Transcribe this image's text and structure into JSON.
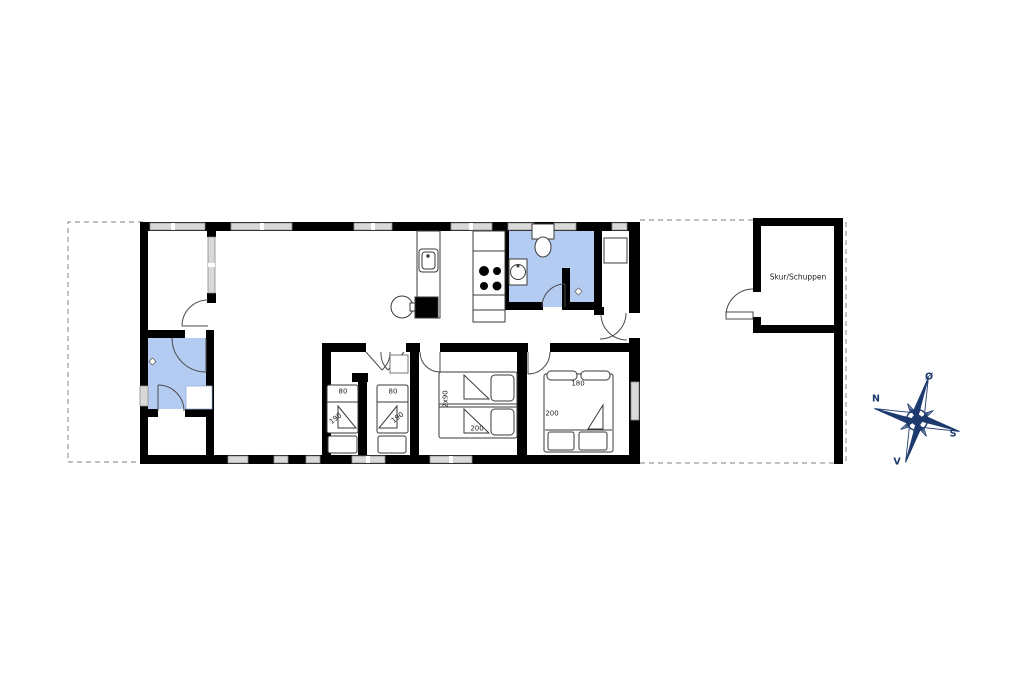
{
  "shed": {
    "label": "Skur/Schuppen"
  },
  "bedrooms": [
    {
      "room": "small-bedroom-1",
      "bed_width_cm": "80",
      "bed_length_cm": "190"
    },
    {
      "room": "small-bedroom-2",
      "bed_width_cm": "80",
      "bed_length_cm": "190"
    },
    {
      "room": "double-bedroom",
      "bed_width_cm": "2x90",
      "bed_length_cm": "200"
    },
    {
      "room": "master-bedroom",
      "bed_width_cm": "180",
      "bed_length_cm": "200"
    }
  ],
  "compass": {
    "north": "N",
    "east": "Ø",
    "south": "S",
    "west": "V"
  },
  "colors": {
    "wall": "#000000",
    "bathroom_fill": "#b4ccf2",
    "window_fill": "#d9d9d9",
    "outline_dash": "#9a9a9a",
    "compass": "#1d3a6e",
    "furniture_stroke": "#3a3a3a"
  }
}
